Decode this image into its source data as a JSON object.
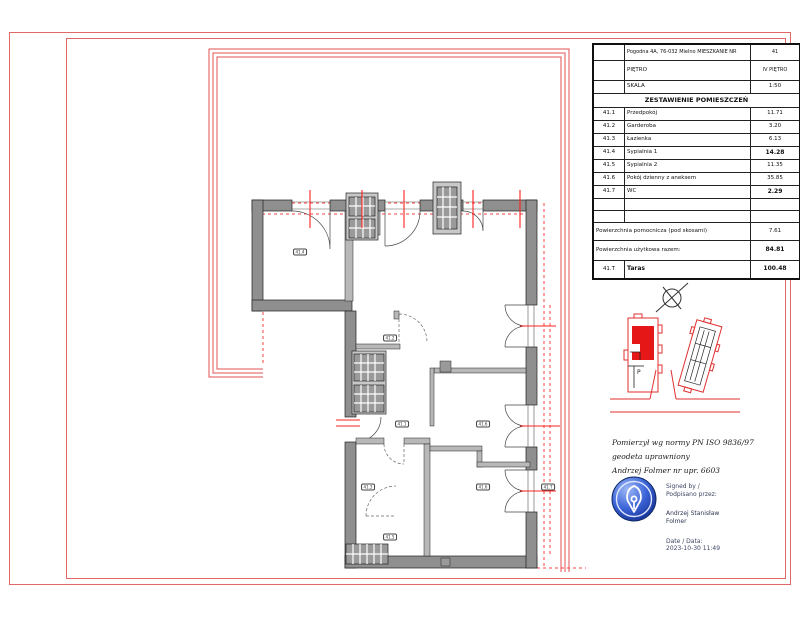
{
  "title_block": {
    "address_label": "Pogodna 4A, 76-032 Mielno MIESZKANIE NR",
    "apartment_no": "41",
    "floor_label": "PIĘTRO",
    "floor_value": "IV\nPIĘTRO",
    "scale_label": "SKALA",
    "scale_value": "1:50",
    "rooms_header": "ZESTAWIENIE POMIESZCZEŃ",
    "rooms": [
      {
        "no": "41.1",
        "name": "Przedpokój",
        "area": "11.71",
        "bold": false
      },
      {
        "no": "41.2",
        "name": "Garderoba",
        "area": "3.20",
        "bold": false
      },
      {
        "no": "41.3",
        "name": "Łazienka",
        "area": "6.13",
        "bold": false
      },
      {
        "no": "41.4",
        "name": "Sypialnia 1",
        "area": "14.28",
        "bold": true
      },
      {
        "no": "41.5",
        "name": "Sypialnia 2",
        "area": "11.35",
        "bold": false
      },
      {
        "no": "41.6",
        "name": "Pokój dzienny z aneksem",
        "area": "35.85",
        "bold": false
      },
      {
        "no": "41.7",
        "name": "WC",
        "area": "2.29",
        "bold": true
      }
    ],
    "aux_area_label": "Powierzchnia pomocnicza (pod skosami)",
    "aux_area_value": "7.61",
    "total_label": "Powierzchnia użytkowa razem:",
    "total_value": "84.81",
    "terrace_no": "41.T",
    "terrace_label": "Taras",
    "terrace_value": "100.48"
  },
  "surveyor_note": {
    "line1": "Pomierzył wg normy  PN ISO 9836/97",
    "line2": "geodeta uprawniony",
    "line3": "Andrzej Folmer nr upr. 6603"
  },
  "signature": {
    "signed_by": "Signed by /\nPodpisano przez:",
    "name": "Andrzej Stanisław\nFolmer",
    "date": "Date / Data:\n2023-10-30 11:49"
  },
  "plan": {
    "room_tags": [
      {
        "x": 300,
        "y": 252,
        "label": "41.4"
      },
      {
        "x": 390,
        "y": 338,
        "label": "41.2"
      },
      {
        "x": 402,
        "y": 424,
        "label": "41.1"
      },
      {
        "x": 483,
        "y": 424,
        "label": "41.6"
      },
      {
        "x": 368,
        "y": 487,
        "label": "41.3"
      },
      {
        "x": 483,
        "y": 487,
        "label": "41.6"
      },
      {
        "x": 548,
        "y": 487,
        "label": "41.T"
      },
      {
        "x": 390,
        "y": 537,
        "label": "41.5"
      }
    ]
  },
  "colors": {
    "sheet_frame_red": "#e26868",
    "roof_line_red": "#e25050",
    "centerline_red": "#ff2020",
    "wall_gray": "#8f8f8f",
    "partition_gray": "#b8b8b8",
    "stamp_blue": "#16308f",
    "site_highlight_red": "#e61717"
  }
}
